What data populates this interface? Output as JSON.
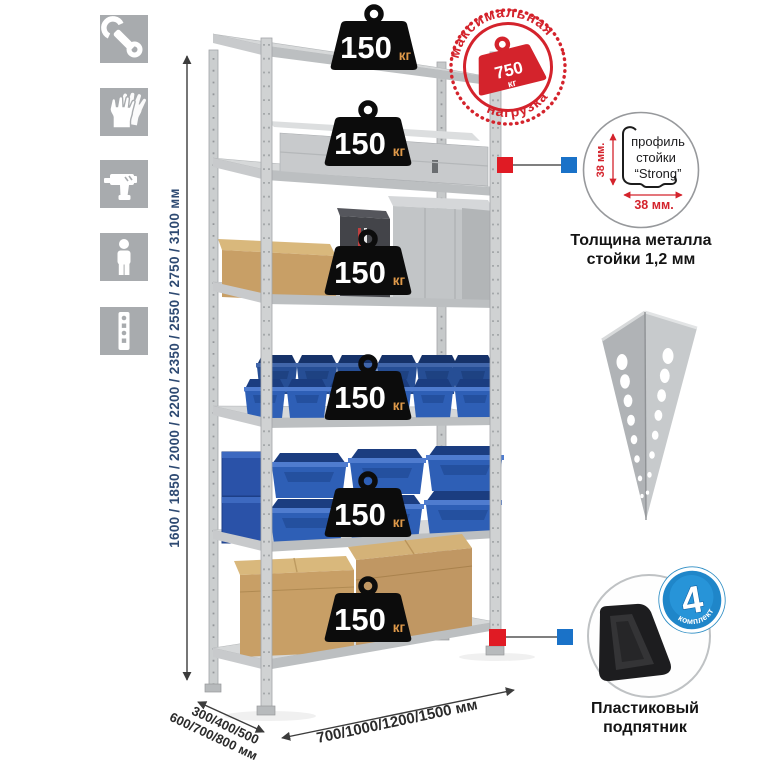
{
  "sidebar": {
    "icons": [
      {
        "name": "wrench"
      },
      {
        "name": "gloves"
      },
      {
        "name": "drill"
      },
      {
        "name": "person"
      },
      {
        "name": "rack-post"
      }
    ]
  },
  "dimensions": {
    "height_label": "1600 / 1850 / 2000 / 2200 / 2350 / 2550 / 2750 / 3100 мм",
    "depth_label_line1": "300/400/500",
    "depth_label_line2": "600/700/800 мм",
    "width_label": "700/1000/1200/1500 мм"
  },
  "shelves": {
    "count": 6,
    "load_value": "150",
    "load_unit": "кг"
  },
  "max_load_stamp": {
    "arc_top": "максимальная",
    "arc_bottom": "нагрузка",
    "value": "750",
    "unit": "кг"
  },
  "profile_callout": {
    "line1": "профиль",
    "line2": "стойки",
    "line3": "“Strong”",
    "dim_vertical": "38 мм.",
    "dim_horizontal": "38 мм.",
    "caption_line1": "Толщина металла",
    "caption_line2": "стойки 1,2 мм"
  },
  "foot_callout": {
    "badge_value": "4",
    "badge_arc": "в комплекте",
    "caption_line1": "Пластиковый",
    "caption_line2": "подпятник"
  },
  "colors": {
    "accent_red": "#d4232c",
    "connector_red": "#e01b24",
    "connector_blue": "#1a72c8",
    "badge_blue": "#1f86c9",
    "metal_gray": "#cbcecf",
    "bin_blue": "#2e5fb6"
  }
}
